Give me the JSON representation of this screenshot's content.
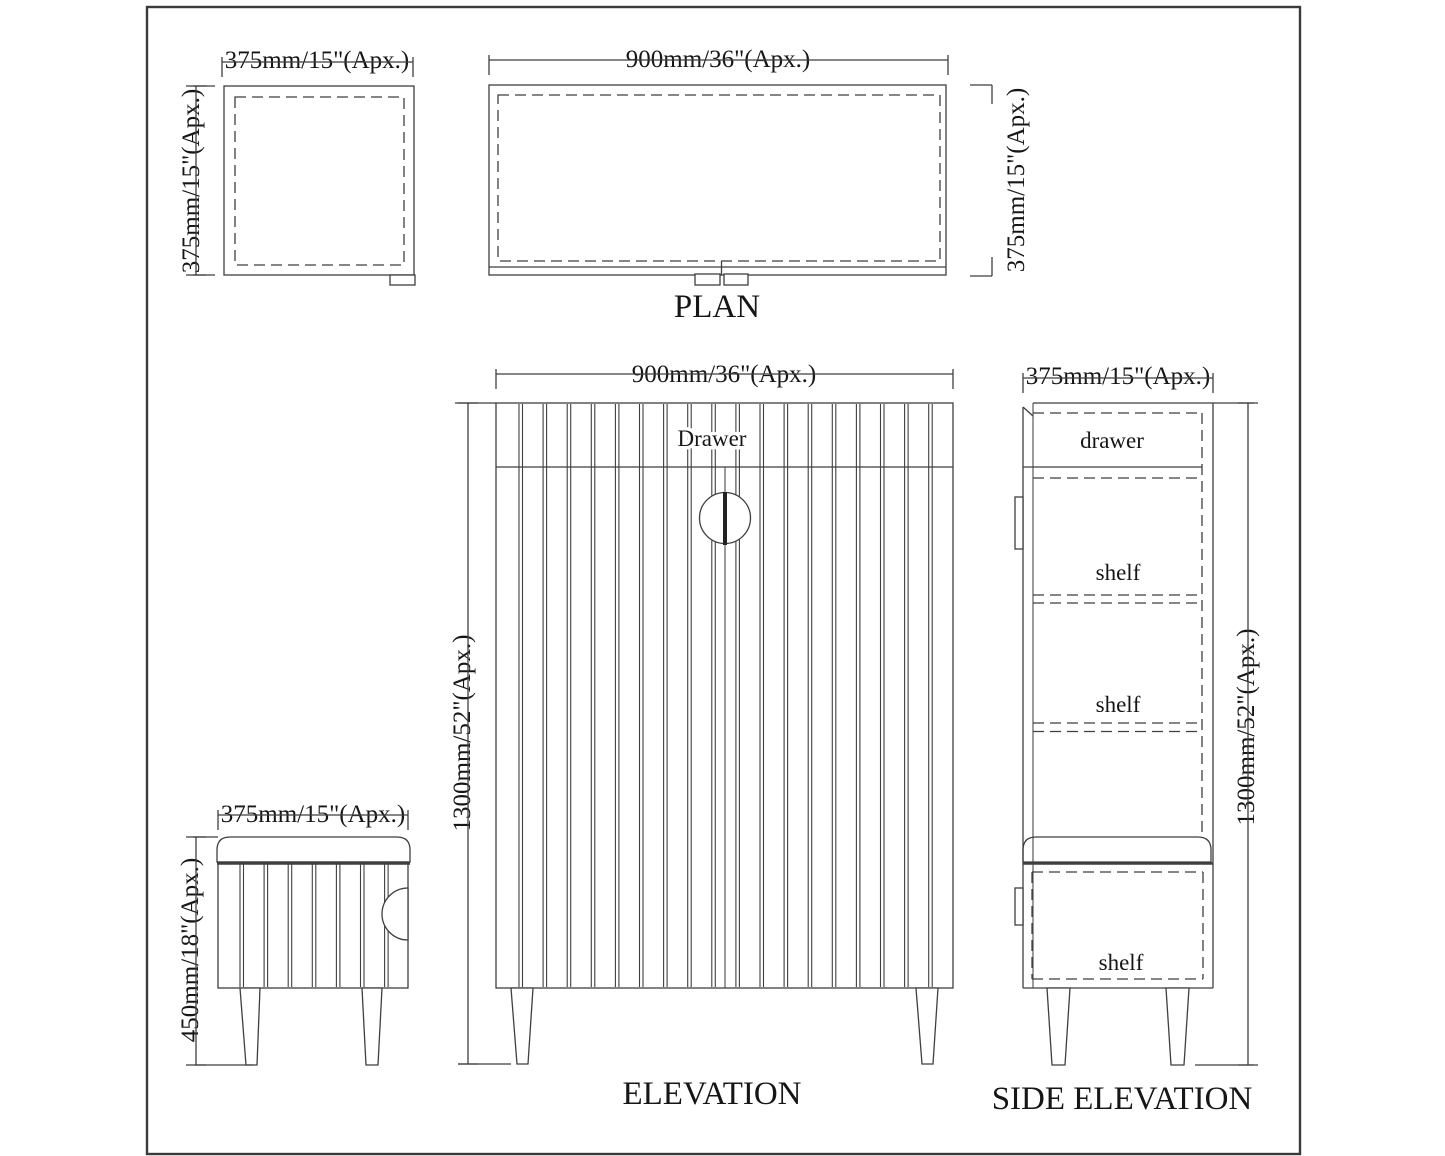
{
  "colors": {
    "ink": "#3f3f3f",
    "text": "#161616",
    "paper": "#ffffff"
  },
  "views": {
    "small_plan": {
      "width_label": "375mm/15\"(Apx.)",
      "height_label": "375mm/15\"(Apx.)"
    },
    "plan": {
      "caption": "PLAN",
      "width_label": "900mm/36\"(Apx.)",
      "height_label": "375mm/15\"(Apx.)"
    },
    "elevation": {
      "caption": "ELEVATION",
      "width_label": "900mm/36\"(Apx.)",
      "height_label": "1300mm/52\"(Apx.)",
      "drawer_label": "Drawer"
    },
    "side_elevation": {
      "caption": "SIDE ELEVATION",
      "width_label": "375mm/15\"(Apx.)",
      "height_label": "1300mm/52\"(Apx.)",
      "drawer_label": "drawer",
      "shelf_labels": [
        "shelf",
        "shelf",
        "shelf"
      ]
    },
    "bench": {
      "width_label": "375mm/15\"(Apx.)",
      "height_label": "450mm/18\"(Apx.)"
    }
  }
}
